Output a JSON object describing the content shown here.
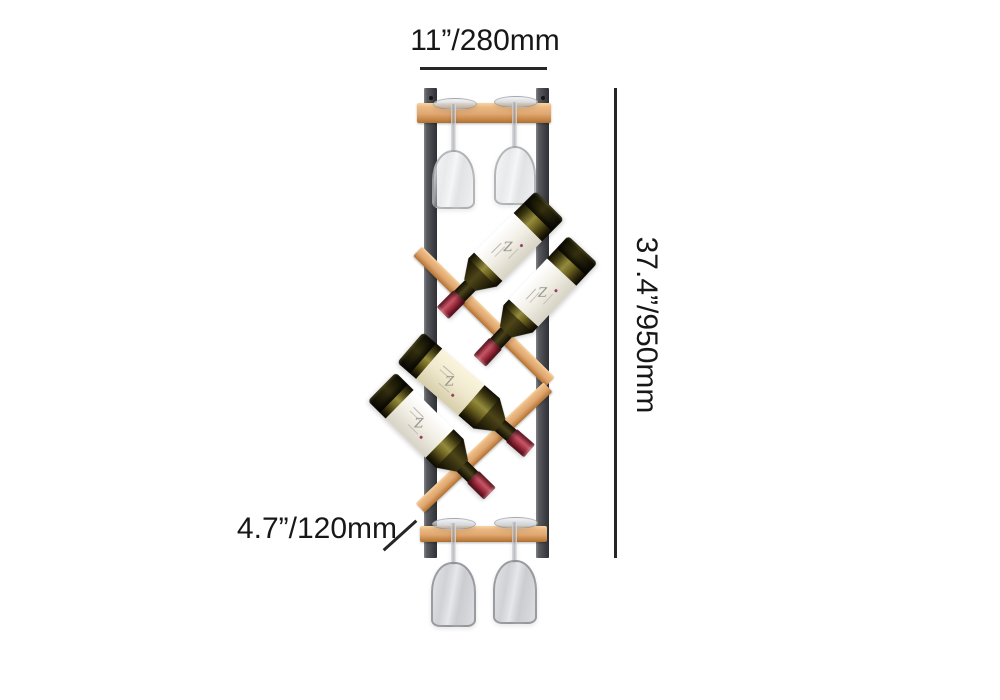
{
  "image_type": "product dimension diagram",
  "annotations": {
    "width": {
      "label": "11”/280mm"
    },
    "height": {
      "label": "37.4”/950mm"
    },
    "depth": {
      "label": "4.7”/120mm"
    }
  },
  "product": {
    "description": "wall-mounted zig-zag wine rack with bottles and stemware",
    "bottle_count": 4,
    "glass_count": 4,
    "bottle_label_mark": "Z",
    "colors": {
      "metal_frame": "#46474c",
      "wood": "#dfa771",
      "bottle_glass_dark": "#241e06",
      "bottle_glass_light": "#948b3c",
      "foil_red": "#8e2233",
      "label_white": "#f5f2ea",
      "label_cream": "#efe8cd",
      "dimension_ink": "#262626",
      "background": "#ffffff"
    }
  }
}
